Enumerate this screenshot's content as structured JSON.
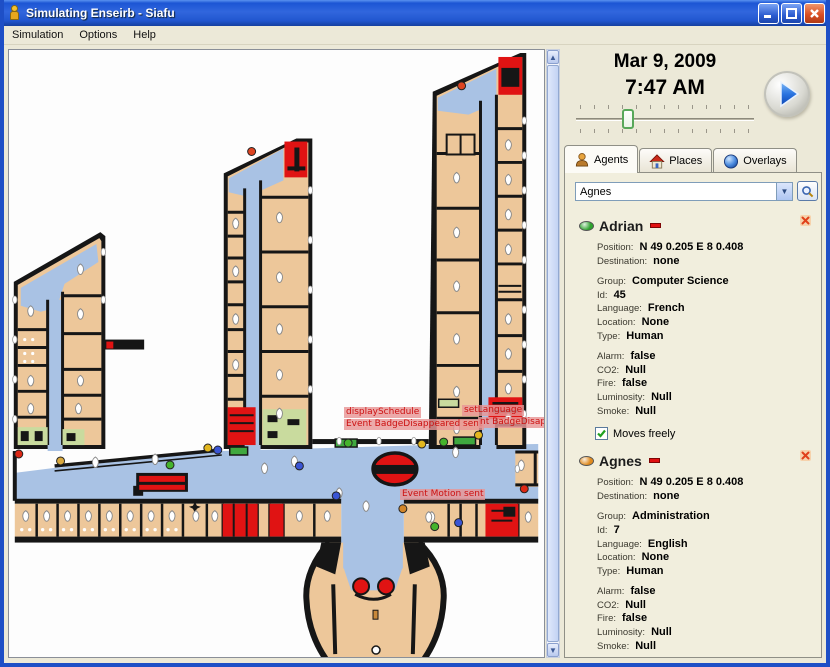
{
  "window": {
    "title": "Simulating Enseirb - Siafu",
    "controls": {
      "minimize": "minimize",
      "maximize": "maximize",
      "close": "close"
    }
  },
  "menu": {
    "items": [
      "Simulation",
      "Options",
      "Help"
    ]
  },
  "clock": {
    "date": "Mar 9, 2009",
    "time": "7:47 AM"
  },
  "tabs": [
    {
      "label": "Agents",
      "icon": "person-icon",
      "selected": true
    },
    {
      "label": "Places",
      "icon": "house-icon",
      "selected": false
    },
    {
      "label": "Overlays",
      "icon": "sphere-icon",
      "selected": false
    }
  ],
  "agent_selector": {
    "value": "Agnes"
  },
  "agents": [
    {
      "name": "Adrian",
      "status_color": "#2fa32f",
      "groups": [
        [
          {
            "label": "Position:",
            "value": "N 49 0.205 E 8 0.408"
          },
          {
            "label": "Destination:",
            "value": "none"
          }
        ],
        [
          {
            "label": "Group:",
            "value": "Computer Science"
          },
          {
            "label": "Id:",
            "value": "45"
          },
          {
            "label": "Language:",
            "value": "French"
          },
          {
            "label": "Location:",
            "value": "None"
          },
          {
            "label": "Type:",
            "value": "Human"
          }
        ],
        [
          {
            "label": "Alarm:",
            "value": "false"
          },
          {
            "label": "CO2:",
            "value": "Null"
          },
          {
            "label": "Fire:",
            "value": "false"
          },
          {
            "label": "Luminosity:",
            "value": "Null"
          },
          {
            "label": "Smoke:",
            "value": "Null"
          }
        ]
      ],
      "checkbox_label": "Moves freely",
      "checkbox_checked": true
    },
    {
      "name": "Agnes",
      "status_color": "#e08a1e",
      "groups": [
        [
          {
            "label": "Position:",
            "value": "N 49 0.205 E 8 0.408"
          },
          {
            "label": "Destination:",
            "value": "none"
          }
        ],
        [
          {
            "label": "Group:",
            "value": "Administration"
          },
          {
            "label": "Id:",
            "value": "7"
          },
          {
            "label": "Language:",
            "value": "English"
          },
          {
            "label": "Location:",
            "value": "None"
          },
          {
            "label": "Type:",
            "value": "Human"
          }
        ],
        [
          {
            "label": "Alarm:",
            "value": "false"
          },
          {
            "label": "CO2:",
            "value": "Null"
          },
          {
            "label": "Fire:",
            "value": "false"
          },
          {
            "label": "Luminosity:",
            "value": "Null"
          },
          {
            "label": "Smoke:",
            "value": "Null"
          }
        ]
      ],
      "checkbox_label": "Moves freely",
      "checkbox_checked": true
    }
  ],
  "map": {
    "events": [
      {
        "text": "displaySchedule",
        "x": 344,
        "y": 406
      },
      {
        "text": "Event BadgeDisappeared sent",
        "x": 344,
        "y": 418
      },
      {
        "text": "setLanguage",
        "x": 462,
        "y": 404
      },
      {
        "text": "nt BadgeDisapp",
        "x": 478,
        "y": 416
      },
      {
        "text": "Event Motion sent",
        "x": 400,
        "y": 488
      }
    ],
    "agent_dots": [
      {
        "x": 208,
        "y": 449,
        "color": "#e3b71f"
      },
      {
        "x": 423,
        "y": 445,
        "color": "#e3b71f"
      },
      {
        "x": 480,
        "y": 436,
        "color": "#e3b71f"
      },
      {
        "x": 218,
        "y": 451,
        "color": "#3a55d4"
      },
      {
        "x": 300,
        "y": 467,
        "color": "#3a55d4"
      },
      {
        "x": 337,
        "y": 497,
        "color": "#3a55d4"
      },
      {
        "x": 460,
        "y": 524,
        "color": "#3a55d4"
      },
      {
        "x": 170,
        "y": 466,
        "color": "#45b32c"
      },
      {
        "x": 445,
        "y": 443,
        "color": "#45b32c"
      },
      {
        "x": 436,
        "y": 528,
        "color": "#45b32c"
      },
      {
        "x": 349,
        "y": 444,
        "color": "#45b32c"
      },
      {
        "x": 404,
        "y": 510,
        "color": "#d2862a"
      },
      {
        "x": 60,
        "y": 462,
        "color": "#d9a93f"
      },
      {
        "x": 18,
        "y": 455,
        "color": "#dd2815"
      },
      {
        "x": 252,
        "y": 151,
        "color": "#dd4422"
      },
      {
        "x": 463,
        "y": 85,
        "color": "#dd4422"
      },
      {
        "x": 526,
        "y": 490,
        "color": "#dd2815"
      }
    ]
  }
}
